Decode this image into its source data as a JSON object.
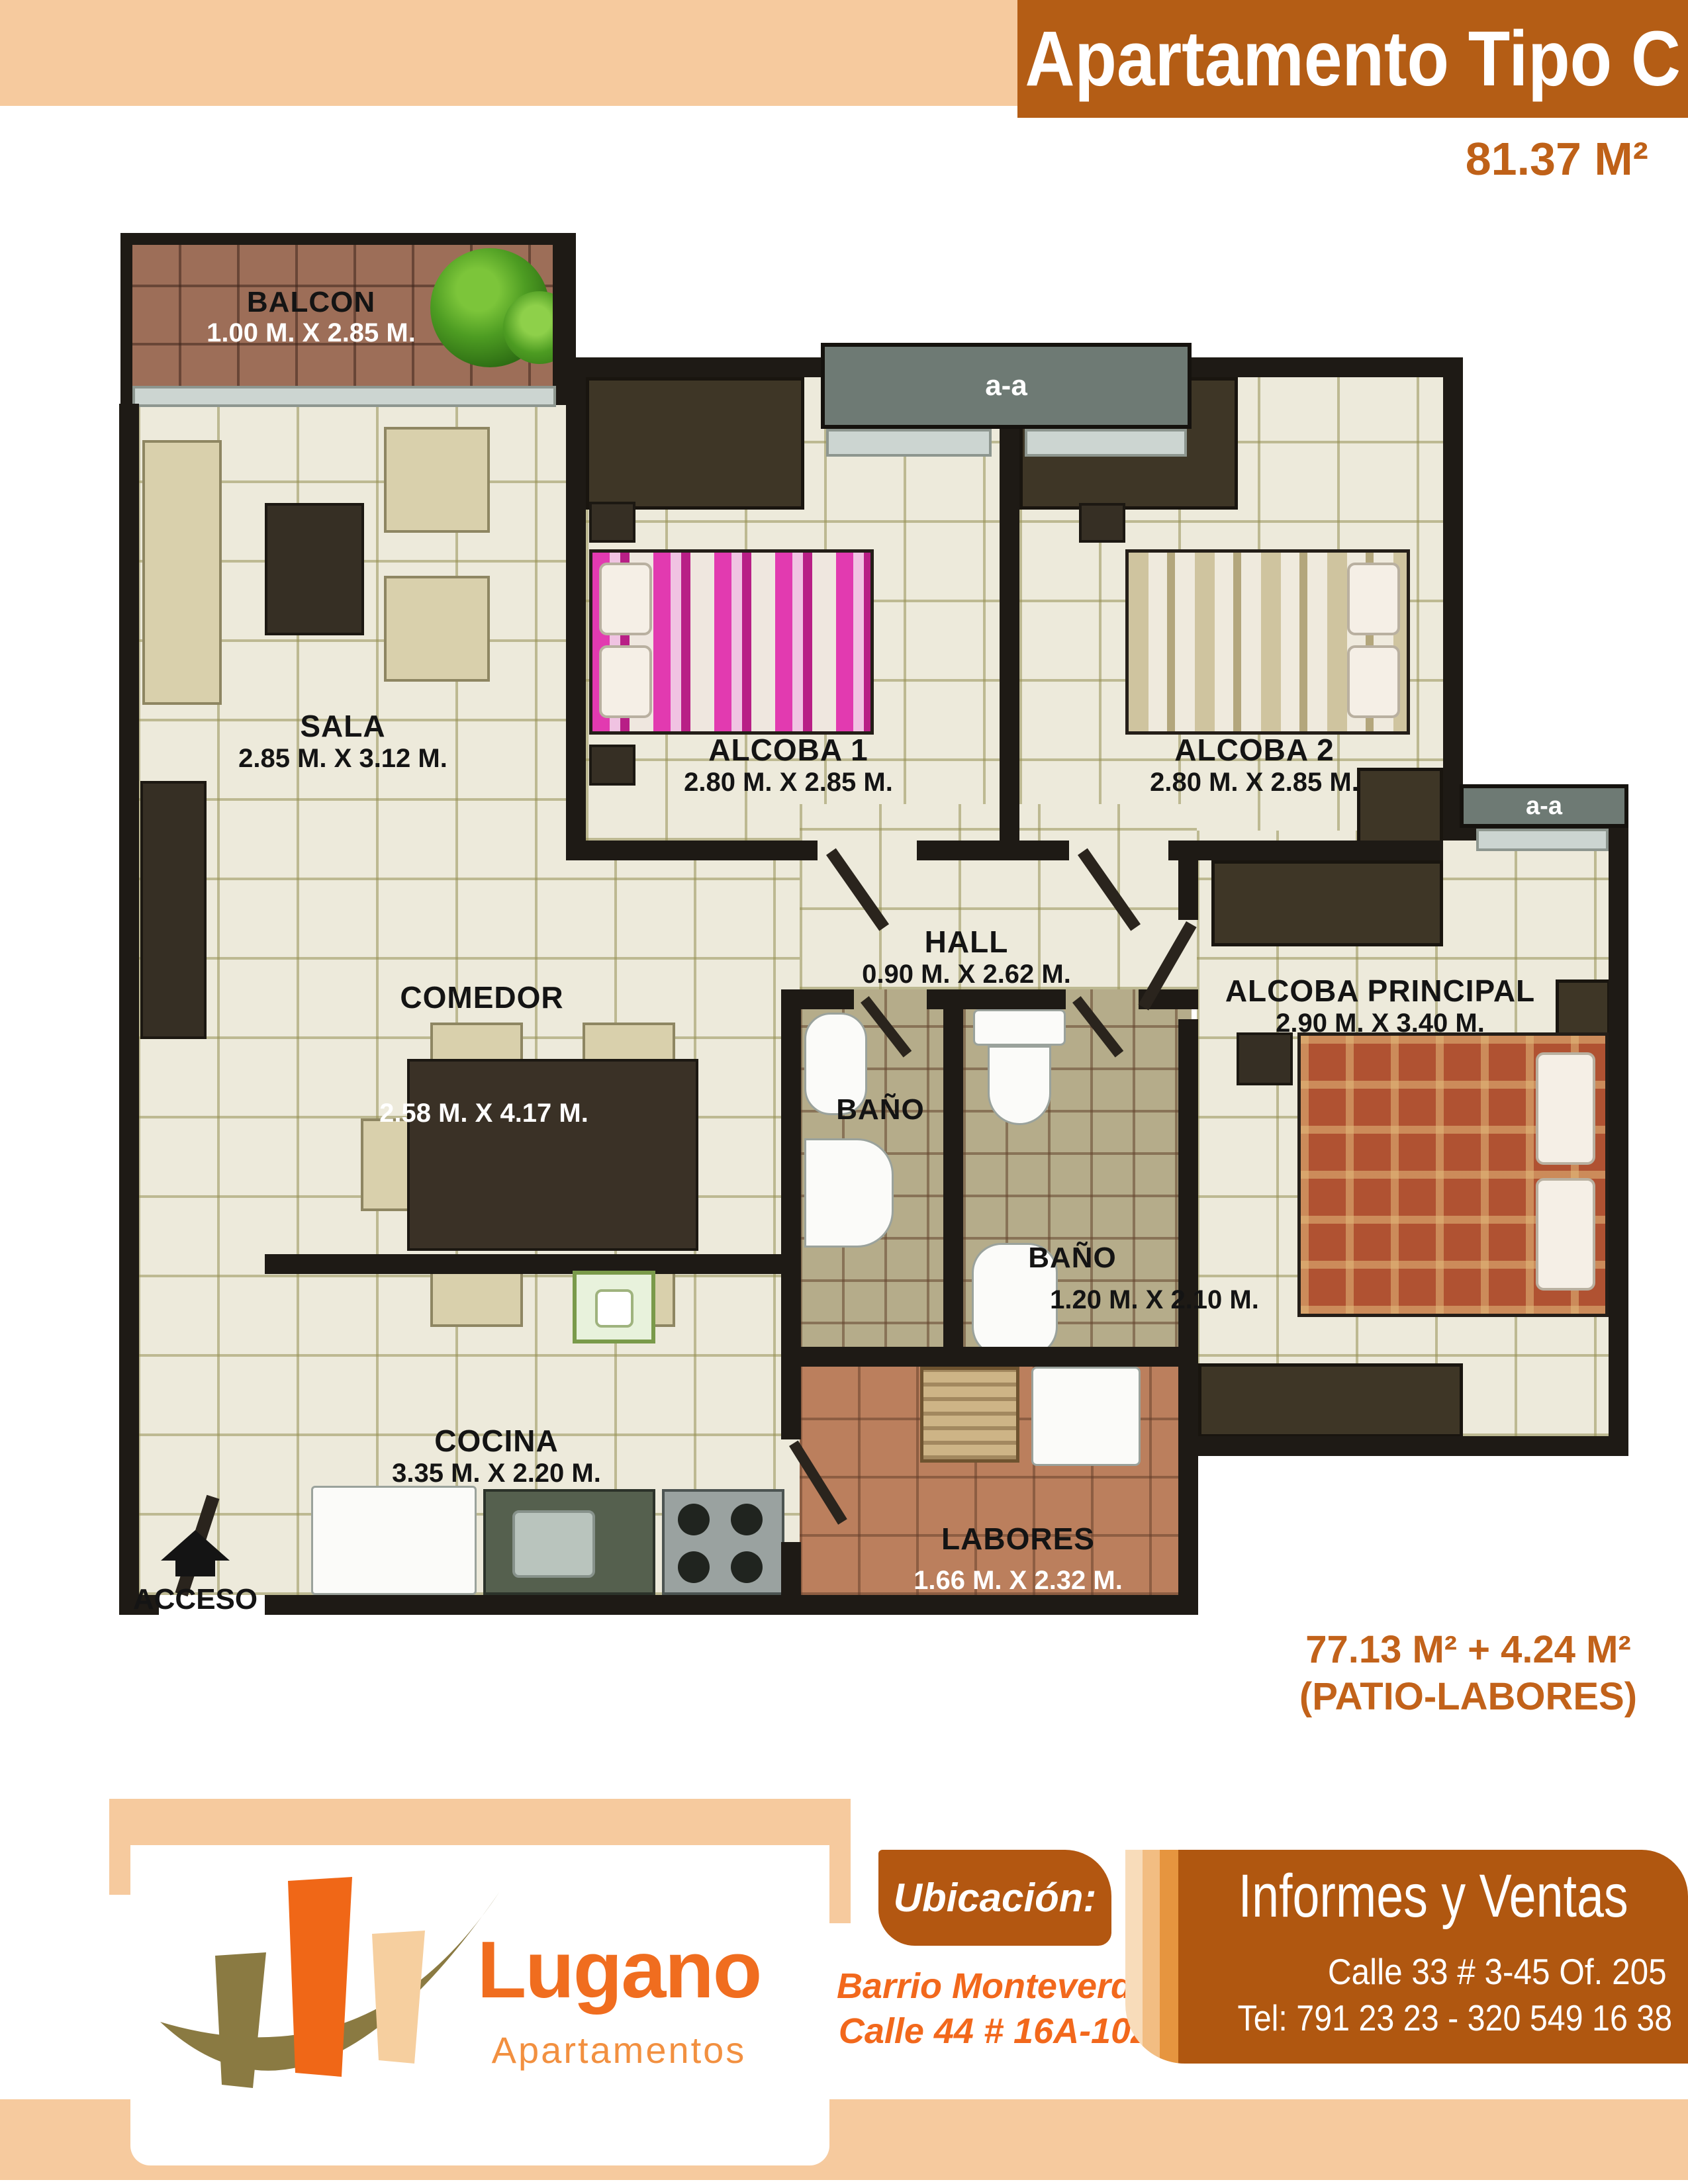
{
  "header": {
    "title": "Apartamento Tipo C",
    "area": "81.37 M²"
  },
  "plan": {
    "section_marker": "a-a",
    "access_label": "ACCESO",
    "rooms": [
      {
        "id": "balcon",
        "name": "BALCON",
        "dims": "1.00 M. X 2.85 M."
      },
      {
        "id": "sala",
        "name": "SALA",
        "dims": "2.85 M. X 3.12 M."
      },
      {
        "id": "alcoba-1",
        "name": "ALCOBA 1",
        "dims": "2.80 M. X 2.85 M."
      },
      {
        "id": "alcoba-2",
        "name": "ALCOBA 2",
        "dims": "2.80 M. X 2.85 M."
      },
      {
        "id": "hall",
        "name": "HALL",
        "dims": "0.90 M. X 2.62 M."
      },
      {
        "id": "comedor",
        "name": "COMEDOR",
        "dims": "2.58 M. X 4.17 M."
      },
      {
        "id": "alcoba-principal",
        "name": "ALCOBA PRINCIPAL",
        "dims": "2.90 M. X 3.40 M."
      },
      {
        "id": "bano-1",
        "name": "BAÑO",
        "dims": ""
      },
      {
        "id": "bano-2",
        "name": "BAÑO",
        "dims": "1.20 M. X 2.10 M."
      },
      {
        "id": "cocina",
        "name": "COCINA",
        "dims": "3.35 M. X 2.20 M."
      },
      {
        "id": "labores",
        "name": "LABORES",
        "dims": "1.66 M. X 2.32 M."
      }
    ]
  },
  "area_note": {
    "line1": "77.13 M² + 4.24 M²",
    "line2": "(PATIO-LABORES)"
  },
  "footer": {
    "logo": {
      "name": "Lugano",
      "subtitle": "Apartamentos"
    },
    "ubicacion": {
      "title": "Ubicación:",
      "line1": "Barrio Monteverde",
      "line2": "Calle 44 # 16A-102"
    },
    "informes": {
      "title": "Informes y Ventas",
      "line1": "Calle 33 # 3-45 Of. 205",
      "line2": "Tel: 791 23 23 - 320 549 16 38"
    }
  },
  "colors": {
    "header_orange": "#b45d15",
    "accent_orange": "#c2621a",
    "logo_orange": "#f06d1f",
    "peach": "#f6ca9e",
    "panel_brown": "#b05710",
    "floor_cream": "#edeadb",
    "wall_dark": "#1e1a15"
  }
}
